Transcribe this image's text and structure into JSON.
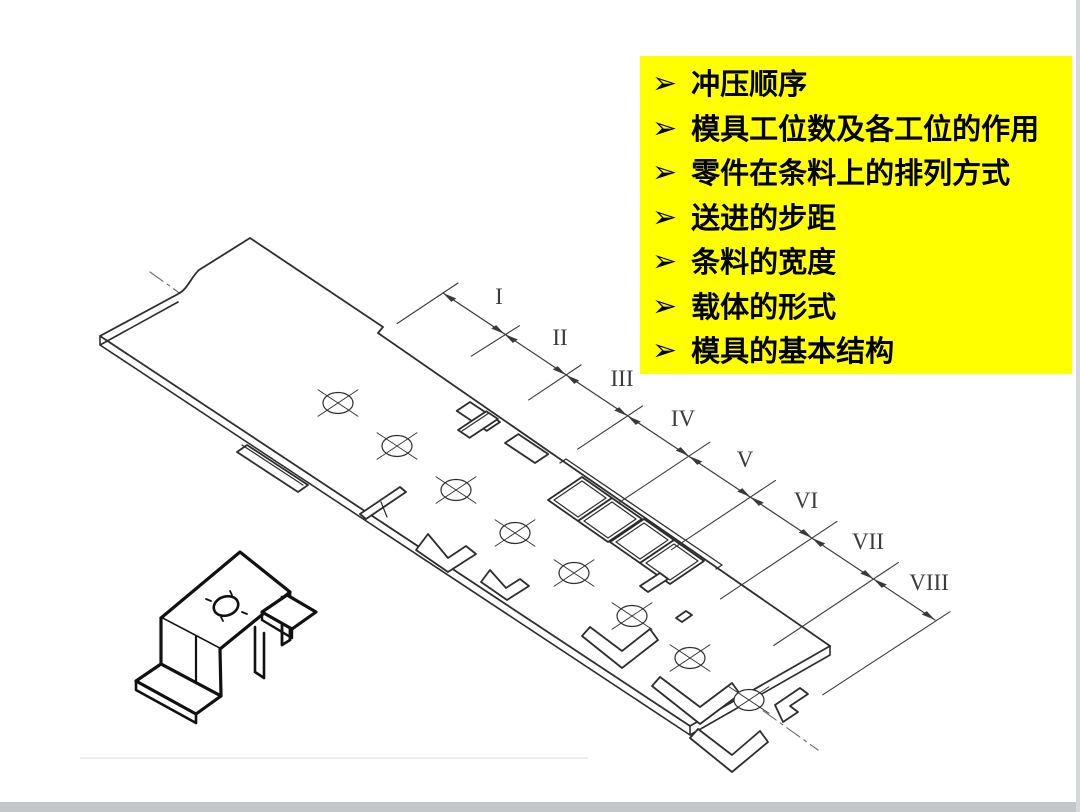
{
  "slide": {
    "background_color": "#ffffff",
    "bottom_bar_color": "#c3c7ca",
    "right_border_color": "#d6d9db"
  },
  "callout": {
    "bg_color": "#ffff00",
    "text_color": "#000000",
    "bullet_icon": "➢",
    "items": [
      "冲压顺序",
      "模具工位数及各工位的作用",
      "零件在条料上的排列方式",
      "送进的步距",
      "条料的宽度",
      "载体的形式",
      "模具的基本结构"
    ]
  },
  "diagram": {
    "description": "级进模排样图（条料上 I–VIII 工位的冲压顺序立体图）",
    "line_color": "#2d2d2d",
    "stations": [
      {
        "label": "I"
      },
      {
        "label": "II"
      },
      {
        "label": "III"
      },
      {
        "label": "IV"
      },
      {
        "label": "V"
      },
      {
        "label": "VI"
      },
      {
        "label": "VII"
      },
      {
        "label": "VIII"
      }
    ]
  }
}
